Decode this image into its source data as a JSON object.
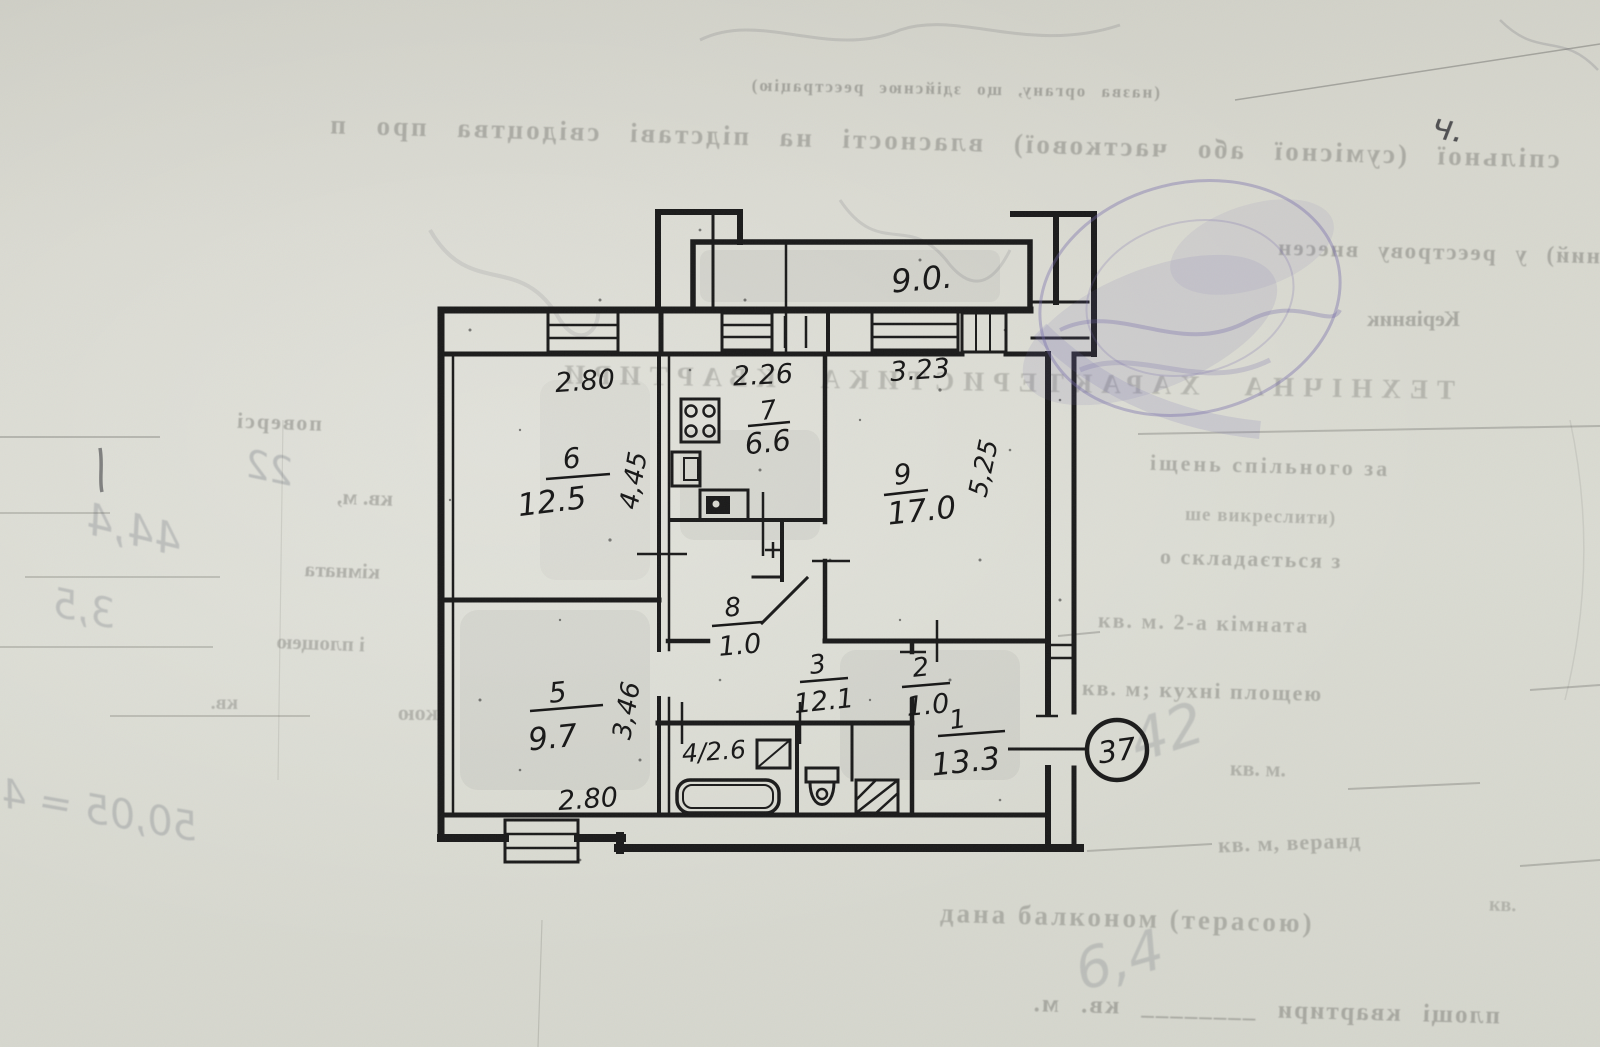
{
  "colors": {
    "wall": "#1a1a1a",
    "paper": "#d8d8cf",
    "stamp": "#7066a8"
  },
  "plan": {
    "balcony_area": "9.0.",
    "apartment_circle": "37",
    "rooms": [
      {
        "number": "6",
        "area": "12.5"
      },
      {
        "number": "7",
        "area": "6.6"
      },
      {
        "number": "9",
        "area": "17.0"
      },
      {
        "number": "8",
        "area": "1.0"
      },
      {
        "number": "5",
        "area": "9.7"
      },
      {
        "number": "3",
        "area": "12.1"
      },
      {
        "number": "2",
        "area": "1.0"
      },
      {
        "number": "1",
        "area": "13.3"
      }
    ],
    "room4_label": "4/2.6",
    "dims": {
      "room6_top": "2.80",
      "room7_top": "2.26",
      "room9_top": "3.23",
      "room6_right": "4,45",
      "room9_right": "5,25",
      "room5_right": "3,46",
      "room5_bottom": "2.80"
    }
  },
  "form": {
    "mirrored": {
      "org_line": "(назва органу, що здійснює реєстрацію)",
      "ownership_line": "спільної (сумісної або часткової) власності на підставі свідоцтва про п",
      "register_line": "ний) у реєстрову внесен",
      "kerivnyk": "Керівник",
      "heading": "ТЕХНІЧНА ХАРАКТЕРИСТИКА КВАРТИРИ",
      "poversi": "поверсі",
      "kv_m_1": "кв. м,",
      "kimnata": "кімната",
      "i_ploshcheyu": "і площею",
      "kv": "кв.",
      "koyu": "кою",
      "apt_area_line": "площі квартири ________ кв. м."
    },
    "fragments": {
      "spilnogo": "іщень спільного за",
      "vykreslyty": "ше викреслити)",
      "skladayetsya": "о складається з",
      "kimnata2": "кв. м. 2-а кімната",
      "kuhnya": "кв. м; кухні площею",
      "kv_m": "кв. м.",
      "veranda": "кв. м, веранд",
      "balkon": "дана балконом (терасою)",
      "kv_small": "кв."
    },
    "handwriting": {
      "h22": "22",
      "h444": "44,4",
      "h35": "3,5",
      "h5005": "50,05 = 4",
      "h42": "42",
      "h64": "6,4",
      "mark": "ч."
    }
  }
}
